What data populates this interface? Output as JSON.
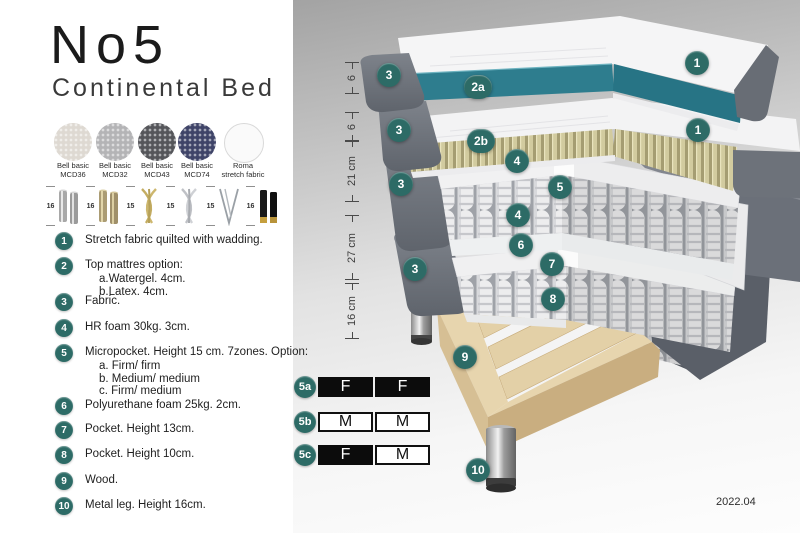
{
  "header": {
    "title": "No5",
    "subtitle": "Continental Bed"
  },
  "swatches": [
    {
      "line1": "Bell basic",
      "line2": "MCD36",
      "color": "#ded9d2"
    },
    {
      "line1": "Bell basic",
      "line2": "MCD32",
      "color": "#b4b4b6"
    },
    {
      "line1": "Bell basic",
      "line2": "MCD43",
      "color": "#55565a"
    },
    {
      "line1": "Bell basic",
      "line2": "MCD74",
      "color": "#3f4468"
    },
    {
      "line1": "Roma",
      "line2": "stretch fabric",
      "color": "#fafafa"
    }
  ],
  "legs_options": [
    {
      "size": "16",
      "type": "cylinder-chrome"
    },
    {
      "size": "16",
      "type": "cylinder-brass"
    },
    {
      "size": "15",
      "type": "twisted-gold"
    },
    {
      "size": "15",
      "type": "twisted-silver"
    },
    {
      "size": "15",
      "type": "hairpin"
    },
    {
      "size": "16",
      "type": "black-gold-tip"
    }
  ],
  "spec_list": [
    {
      "num": "1",
      "text": "Stretch fabric quilted with wadding."
    },
    {
      "num": "2",
      "text": "Top mattres option:",
      "sub": [
        "a.Watergel. 4cm.",
        "b.Latex. 4cm."
      ]
    },
    {
      "num": "3",
      "text": "Fabric."
    },
    {
      "num": "4",
      "text": "HR foam 30kg. 3cm."
    },
    {
      "num": "5",
      "text": "Micropocket. Height 15 cm. 7zones. Option:",
      "sub": [
        "a. Firm/ firm",
        "b. Medium/ medium",
        "c. Firm/ medium"
      ]
    },
    {
      "num": "6",
      "text": "Polyurethane foam 25kg. 2cm."
    },
    {
      "num": "7",
      "text": "Pocket. Height 13cm."
    },
    {
      "num": "8",
      "text": "Pocket. Height 10cm."
    },
    {
      "num": "9",
      "text": "Wood."
    },
    {
      "num": "10",
      "text": "Metal leg. Height 16cm."
    }
  ],
  "diagram": {
    "measurements": [
      {
        "label": "6"
      },
      {
        "label": "6"
      },
      {
        "label": "21 cm"
      },
      {
        "label": "27 cm"
      },
      {
        "label": "16 cm"
      }
    ],
    "callouts": [
      {
        "label": "1"
      },
      {
        "label": "3"
      },
      {
        "label": "2a"
      },
      {
        "label": "3"
      },
      {
        "label": "2b"
      },
      {
        "label": "1"
      },
      {
        "label": "4"
      },
      {
        "label": "3"
      },
      {
        "label": "5"
      },
      {
        "label": "4"
      },
      {
        "label": "6"
      },
      {
        "label": "3"
      },
      {
        "label": "7"
      },
      {
        "label": "8"
      },
      {
        "label": "9"
      },
      {
        "label": "10"
      }
    ],
    "version": "2022.04"
  },
  "firmness": {
    "rows": [
      {
        "id": "5a",
        "cells": [
          {
            "letter": "F",
            "style": "dark"
          },
          {
            "letter": "F",
            "style": "dark"
          }
        ]
      },
      {
        "id": "5b",
        "cells": [
          {
            "letter": "M",
            "style": "light"
          },
          {
            "letter": "M",
            "style": "light"
          }
        ]
      },
      {
        "id": "5c",
        "cells": [
          {
            "letter": "F",
            "style": "dark"
          },
          {
            "letter": "M",
            "style": "light"
          }
        ]
      }
    ]
  },
  "colors": {
    "accent_teal": "#2d6b66",
    "mattress_teal": "#2e7d8e",
    "fabric_gray": "#6d727a",
    "latex_khaki": "#d2cb9f",
    "wood": "#e3d0a7"
  }
}
